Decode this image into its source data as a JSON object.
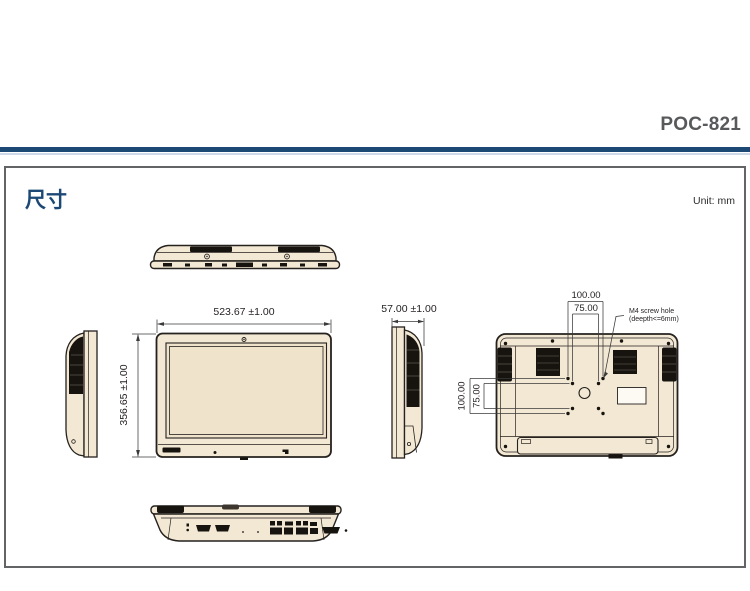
{
  "header": {
    "product_title": "POC-821"
  },
  "content": {
    "section_title": "尺寸",
    "unit_label": "Unit: mm",
    "front_view": {
      "width_dim": "523.67 ±1.00",
      "height_dim": "356.65 ±1.00"
    },
    "side_view": {
      "depth_dim": "57.00 ±1.00"
    },
    "rear_view": {
      "vesa_width_outer": "100.00",
      "vesa_width_inner": "75.00",
      "vesa_height_outer": "100.00",
      "vesa_height_inner": "75.00",
      "screw_note_line1": "M4 screw hole",
      "screw_note_line2": "(deepth<=6mm)"
    },
    "colors": {
      "accent_blue": "#1c4875",
      "accent_blue_light": "#cdd9e8",
      "title_gray": "#58595b",
      "device_fill": "#f3e8d4",
      "screen_fill": "#f0e3cb",
      "line_black": "#231f20"
    }
  }
}
